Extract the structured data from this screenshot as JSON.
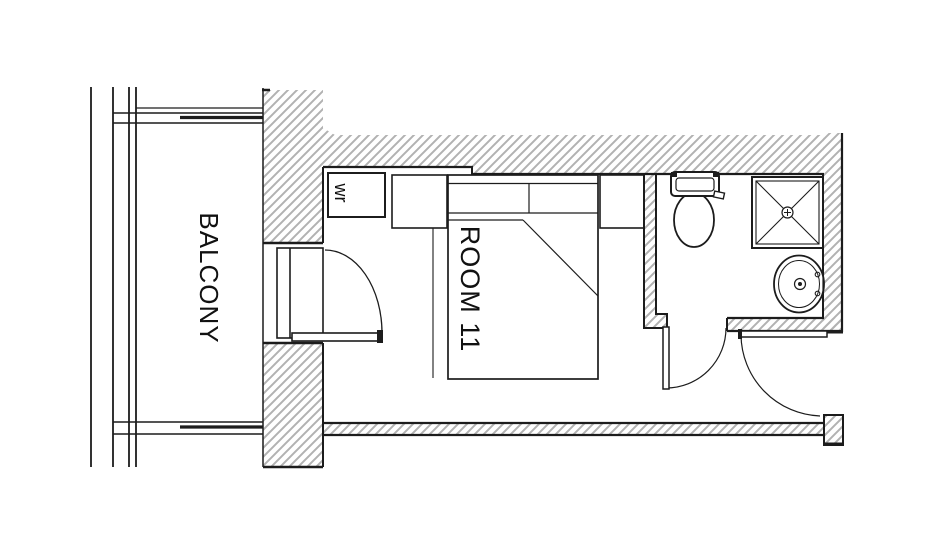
{
  "floorplan": {
    "labels": {
      "balcony": "BALCONY",
      "room": "ROOM 11",
      "wardrobe": "wr"
    },
    "fixtures": [
      "balcony-railing",
      "balcony-door",
      "entry-door",
      "bathroom-door",
      "double-bed",
      "nightstand-left",
      "nightstand-right",
      "wardrobe",
      "toilet",
      "shower",
      "sink"
    ],
    "colors": {
      "background": "#ffffff",
      "line": "#1c1c1c",
      "hatch": "#b2b2b2",
      "text": "#111111"
    }
  }
}
